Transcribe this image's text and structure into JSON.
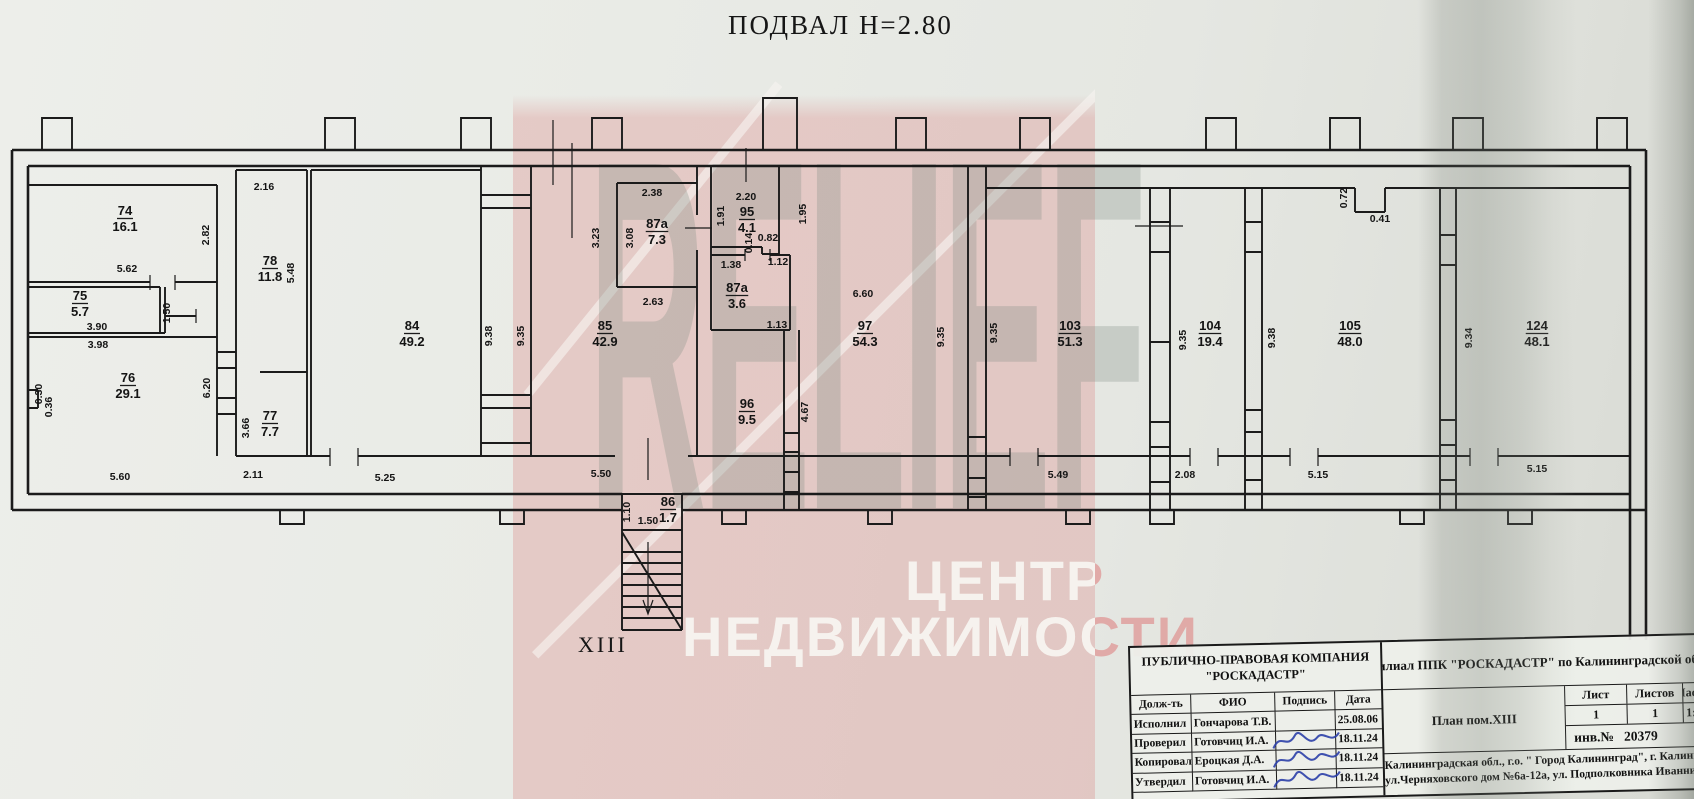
{
  "title": "ПОДВАЛ Н=2.80",
  "section_label": "XIII",
  "watermark": {
    "brand": "RELIEF",
    "line1": "ЦЕНТР",
    "line2": "НЕДВИЖИМОСТИ",
    "band_color": "#dd9896",
    "text_white": "#f7f5f1",
    "brand_gray": "#808f83"
  },
  "plan": {
    "rooms": [
      {
        "n": "74",
        "a": "16.1",
        "x": 125,
        "y": 215
      },
      {
        "n": "75",
        "a": "5.7",
        "x": 80,
        "y": 300
      },
      {
        "n": "76",
        "a": "29.1",
        "x": 128,
        "y": 382
      },
      {
        "n": "78",
        "a": "11.8",
        "x": 270,
        "y": 265
      },
      {
        "n": "77",
        "a": "7.7",
        "x": 270,
        "y": 420
      },
      {
        "n": "84",
        "a": "49.2",
        "x": 412,
        "y": 330
      },
      {
        "n": "85",
        "a": "42.9",
        "x": 605,
        "y": 330
      },
      {
        "n": "87а",
        "a": "7.3",
        "x": 657,
        "y": 228
      },
      {
        "n": "95",
        "a": "4.1",
        "x": 747,
        "y": 216
      },
      {
        "n": "87а",
        "a": "3.6",
        "x": 737,
        "y": 292
      },
      {
        "n": "96",
        "a": "9.5",
        "x": 747,
        "y": 408
      },
      {
        "n": "86",
        "a": "1.7",
        "x": 668,
        "y": 506
      },
      {
        "n": "97",
        "a": "54.3",
        "x": 865,
        "y": 330
      },
      {
        "n": "103",
        "a": "51.3",
        "x": 1070,
        "y": 330
      },
      {
        "n": "104",
        "a": "19.4",
        "x": 1210,
        "y": 330
      },
      {
        "n": "105",
        "a": "48.0",
        "x": 1350,
        "y": 330
      },
      {
        "n": "124",
        "a": "48.1",
        "x": 1537,
        "y": 330
      }
    ],
    "dims": [
      {
        "t": "2.16",
        "x": 264,
        "y": 190
      },
      {
        "t": "2.82",
        "x": 209,
        "y": 235,
        "v": 1
      },
      {
        "t": "5.62",
        "x": 127,
        "y": 272
      },
      {
        "t": "3.90",
        "x": 97,
        "y": 330
      },
      {
        "t": "1.50",
        "x": 170,
        "y": 313,
        "v": 1
      },
      {
        "t": "3.98",
        "x": 98,
        "y": 348
      },
      {
        "t": "0.30",
        "x": 42,
        "y": 394,
        "v": 1
      },
      {
        "t": "0.36",
        "x": 52,
        "y": 407,
        "v": 1
      },
      {
        "t": "6.20",
        "x": 210,
        "y": 388,
        "v": 1
      },
      {
        "t": "5.48",
        "x": 294,
        "y": 273,
        "v": 1
      },
      {
        "t": "3.66",
        "x": 249,
        "y": 428,
        "v": 1
      },
      {
        "t": "5.60",
        "x": 120,
        "y": 480
      },
      {
        "t": "2.11",
        "x": 253,
        "y": 478
      },
      {
        "t": "5.25",
        "x": 385,
        "y": 481
      },
      {
        "t": "9.38",
        "x": 492,
        "y": 336,
        "v": 1
      },
      {
        "t": "9.35",
        "x": 524,
        "y": 336,
        "v": 1
      },
      {
        "t": "2.38",
        "x": 652,
        "y": 196
      },
      {
        "t": "3.23",
        "x": 599,
        "y": 238,
        "v": 1
      },
      {
        "t": "3.08",
        "x": 633,
        "y": 238,
        "v": 1
      },
      {
        "t": "2.63",
        "x": 653,
        "y": 305
      },
      {
        "t": "2.20",
        "x": 746,
        "y": 200
      },
      {
        "t": "1.91",
        "x": 724,
        "y": 216,
        "v": 1
      },
      {
        "t": "0.82",
        "x": 768,
        "y": 241
      },
      {
        "t": "0.14",
        "x": 752,
        "y": 243,
        "v": 1
      },
      {
        "t": "1.95",
        "x": 806,
        "y": 214,
        "v": 1
      },
      {
        "t": "1.38",
        "x": 731,
        "y": 268
      },
      {
        "t": "1.12",
        "x": 778,
        "y": 265
      },
      {
        "t": "1.13",
        "x": 777,
        "y": 328
      },
      {
        "t": "4.67",
        "x": 808,
        "y": 412,
        "v": 1
      },
      {
        "t": "5.50",
        "x": 601,
        "y": 477
      },
      {
        "t": "1.50",
        "x": 648,
        "y": 524
      },
      {
        "t": "1.10",
        "x": 630,
        "y": 512,
        "v": 1
      },
      {
        "t": "6.60",
        "x": 863,
        "y": 297
      },
      {
        "t": "9.35",
        "x": 944,
        "y": 337,
        "v": 1
      },
      {
        "t": "9.35",
        "x": 997,
        "y": 333,
        "v": 1
      },
      {
        "t": "5.49",
        "x": 1058,
        "y": 478
      },
      {
        "t": "9.35",
        "x": 1186,
        "y": 340,
        "v": 1
      },
      {
        "t": "2.08",
        "x": 1185,
        "y": 478
      },
      {
        "t": "9.38",
        "x": 1275,
        "y": 338,
        "v": 1
      },
      {
        "t": "5.15",
        "x": 1318,
        "y": 478
      },
      {
        "t": "0.72",
        "x": 1347,
        "y": 198,
        "v": 1
      },
      {
        "t": "0.41",
        "x": 1380,
        "y": 222
      },
      {
        "t": "9.34",
        "x": 1472,
        "y": 338,
        "v": 1
      },
      {
        "t": "5.15",
        "x": 1537,
        "y": 472
      }
    ]
  },
  "title_block": {
    "company_line1": "ПУБЛИЧНО-ПРАВОВАЯ КОМПАНИЯ",
    "company_line2": "\"РОСКАДАСТР\"",
    "columns": [
      "Долж-ть",
      "ФИО",
      "Подпись",
      "Дата"
    ],
    "rows": [
      {
        "role": "Исполнил",
        "name": "Гончарова Т.В.",
        "date": "25.08.06",
        "signed": false
      },
      {
        "role": "Проверил",
        "name": "Готовчиц И.А.",
        "date": "18.11.24",
        "signed": true
      },
      {
        "role": "Копировал",
        "name": "Ероцкая Д.А.",
        "date": "18.11.24",
        "signed": true
      },
      {
        "role": "Утвердил",
        "name": "Готовчиц И.А.",
        "date": "18.11.24",
        "signed": true
      }
    ],
    "branch": "Филиал ППК \"РОСКАДАСТР\" по Калининградской области",
    "plan_label": "План пом.XIII",
    "sheet_label": "Лист",
    "sheet_value": "1",
    "sheets_label": "Листов",
    "sheets_value": "1",
    "scale_label": "Масштаб",
    "scale_value": "1:100",
    "inv_label": "инв.№",
    "inv_value": "20379",
    "address_line1": "Калининградская обл., г.о. \" Город Калининград\", г. Калининград,",
    "address_line2": "ул.Черняховского дом №6а-12а, ул. Подполковника Иванникова дом №4"
  }
}
